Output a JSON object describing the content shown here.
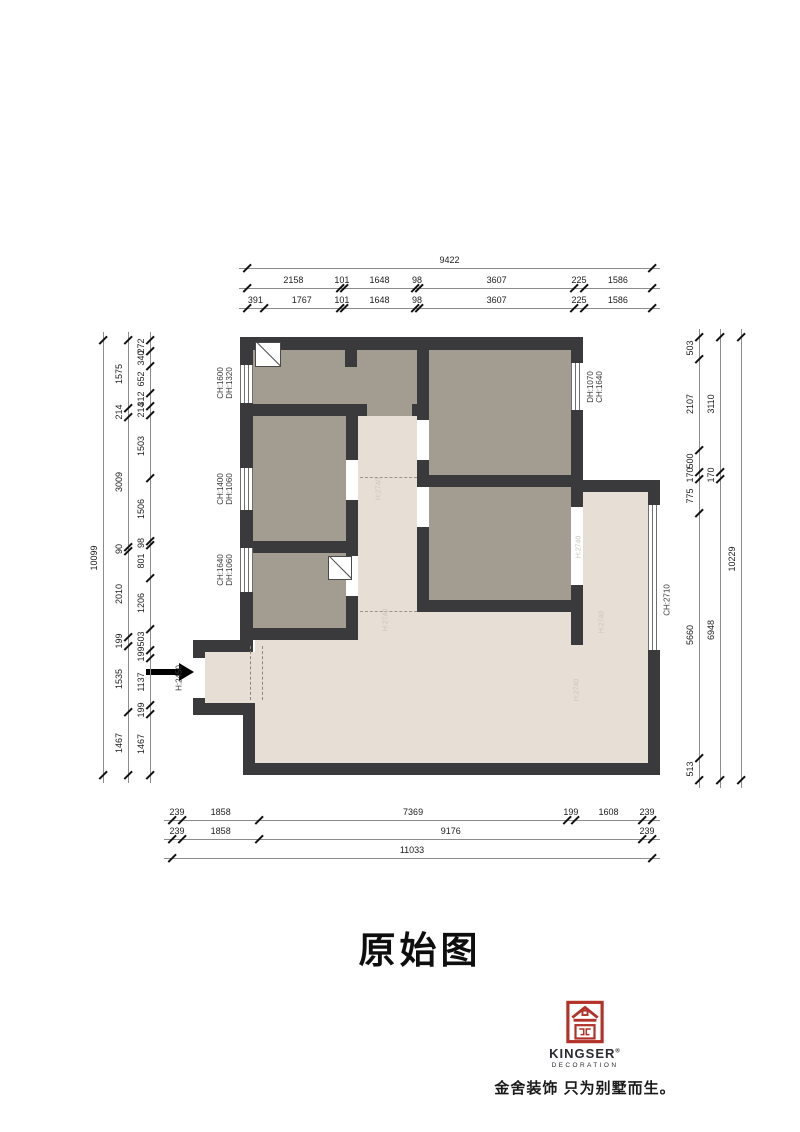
{
  "title": "原始图",
  "plan": {
    "labels": {
      "win_left_top_l1": "CH:1600",
      "win_left_top_l2": "DH:1320",
      "win_left_mid_l1": "CH:1400",
      "win_left_mid_l2": "DH:1060",
      "win_left_low_l1": "CH:1640",
      "win_left_low_l2": "DH:1060",
      "win_right_top_l1": "DH:1070",
      "win_right_top_l2": "CH:1640",
      "win_right_big": "CH:2710",
      "entry_height": "H:2450",
      "faint_1": "H:2740",
      "faint_2": "H:2740",
      "faint_3": "H:2740",
      "faint_4": "H:2740",
      "faint_5": "H:2740"
    }
  },
  "dimensions": {
    "top": {
      "row_total": [
        "9422"
      ],
      "row_mid": [
        "2158",
        "101",
        "1648",
        "98",
        "3607",
        "225",
        "1586"
      ],
      "row_inner": [
        "391",
        "1767",
        "101",
        "1648",
        "98",
        "3607",
        "225",
        "1586"
      ]
    },
    "bottom": {
      "row_inner": [
        "239",
        "1858",
        "7369",
        "199",
        "1608",
        "239"
      ],
      "row_mid": [
        "239",
        "1858",
        "9176",
        "239"
      ],
      "row_total": [
        "11033"
      ]
    },
    "left": {
      "inner": [
        "272",
        "340",
        "652",
        "312",
        "214",
        "1503",
        "1506",
        "98",
        "801",
        "1206",
        "503",
        "199",
        "1137",
        "199",
        "1467"
      ],
      "middle": [
        "1575",
        "214",
        "3009",
        "90",
        "2010",
        "199",
        "1535",
        "1467"
      ],
      "total": [
        "10099"
      ]
    },
    "right": {
      "inner": [
        "503",
        "2107",
        "500",
        "170",
        "775",
        "5660",
        "513"
      ],
      "middle": [
        "3110",
        "170",
        "6948"
      ],
      "total": [
        "10229"
      ]
    }
  },
  "brand": {
    "name": "KINGSER",
    "reg": "®",
    "sub": "DECORATION",
    "slogan": "金舍装饰 只为别墅而生。",
    "red": "#b23229"
  }
}
